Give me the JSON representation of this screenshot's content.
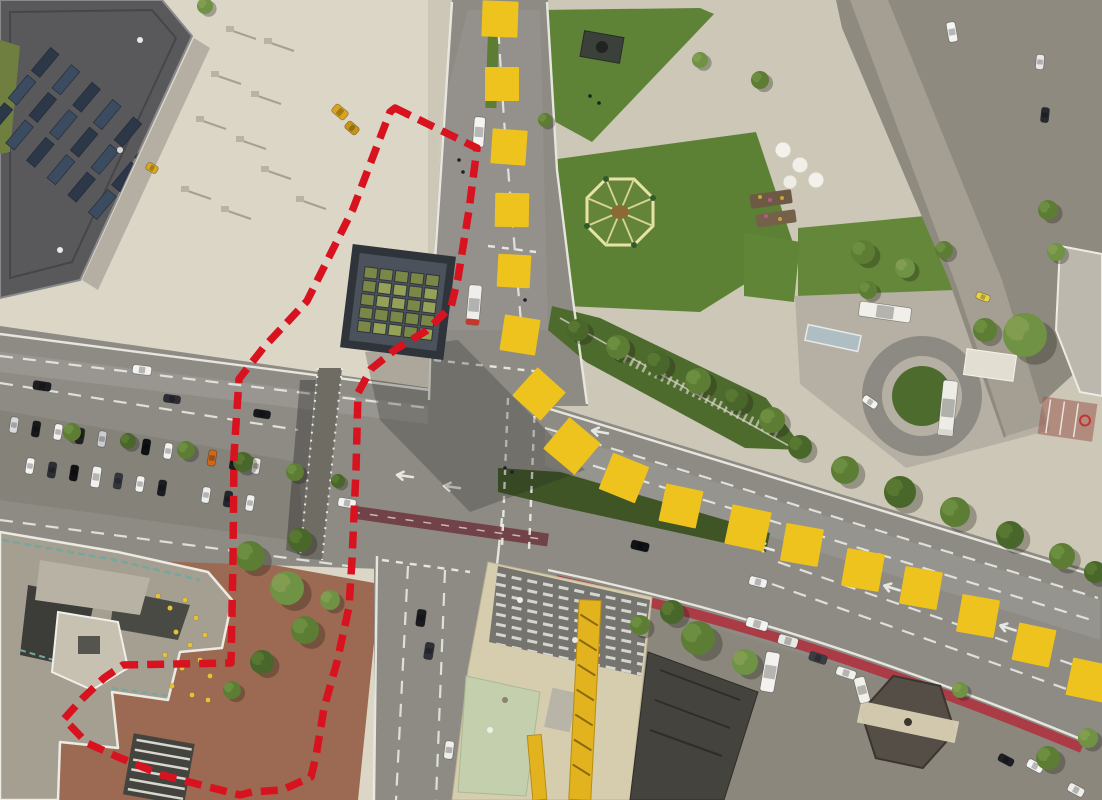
{
  "meta": {
    "kind": "aerial-orthophoto-with-planning-overlays",
    "width": 1102,
    "height": 800
  },
  "palette": {
    "marker_yellow": "#eec31e",
    "boundary_red": "#d9121f",
    "lawn_green": "#5e8236",
    "road_gray": "#8e8b85",
    "plaza_beige": "#dcd6c6",
    "south_plaza_red": "#9c6a52",
    "roof_terracotta": "#b65133",
    "bike_lane_red": "#ae3440",
    "bus_lane_maroon": "#6e3a40",
    "teal_railing": "#6fa39a",
    "tree_tones": [
      "#49662b",
      "#5d7d35",
      "#6f9245",
      "#87a051"
    ]
  },
  "overlays": {
    "boundary": {
      "color": "#d9121f",
      "style": "dashed",
      "stroke_width": 7.5,
      "dash": [
        17,
        9
      ],
      "closed": true,
      "points": [
        [
          395,
          108
        ],
        [
          477,
          148
        ],
        [
          469,
          210
        ],
        [
          458,
          278
        ],
        [
          451,
          307
        ],
        [
          426,
          331
        ],
        [
          396,
          349
        ],
        [
          371,
          369
        ],
        [
          358,
          393
        ],
        [
          356,
          470
        ],
        [
          352,
          560
        ],
        [
          349,
          607
        ],
        [
          337,
          662
        ],
        [
          324,
          708
        ],
        [
          316,
          756
        ],
        [
          311,
          777
        ],
        [
          282,
          790
        ],
        [
          252,
          792
        ],
        [
          240,
          795
        ],
        [
          205,
          786
        ],
        [
          162,
          775
        ],
        [
          118,
          757
        ],
        [
          87,
          743
        ],
        [
          64,
          719
        ],
        [
          82,
          699
        ],
        [
          104,
          678
        ],
        [
          123,
          665
        ],
        [
          175,
          664
        ],
        [
          231,
          663
        ],
        [
          233,
          560
        ],
        [
          234,
          455
        ],
        [
          239,
          379
        ],
        [
          264,
          347
        ],
        [
          307,
          301
        ],
        [
          353,
          209
        ],
        [
          390,
          112
        ]
      ]
    },
    "route_markers": {
      "color": "#eec31e",
      "shape": "square",
      "squares": [
        [
          500,
          19,
          36,
          2
        ],
        [
          502,
          84,
          34,
          0
        ],
        [
          509,
          147,
          35,
          4
        ],
        [
          512,
          210,
          34,
          1
        ],
        [
          514,
          271,
          33,
          3
        ],
        [
          520,
          335,
          36,
          9
        ],
        [
          539,
          394,
          38,
          42
        ],
        [
          572,
          446,
          41,
          40
        ],
        [
          624,
          478,
          39,
          22
        ],
        [
          681,
          506,
          38,
          12
        ],
        [
          748,
          528,
          40,
          12
        ],
        [
          802,
          545,
          38,
          10
        ],
        [
          863,
          570,
          38,
          10
        ],
        [
          921,
          588,
          38,
          10
        ],
        [
          978,
          616,
          38,
          10
        ],
        [
          1034,
          645,
          38,
          12
        ],
        [
          1088,
          680,
          38,
          12
        ]
      ]
    }
  },
  "scene": {
    "features": [
      "solar-roof-building-northwest",
      "paved-plaza",
      "subway-pavilion-glass-roof",
      "city-park-lawns",
      "octagon-fountain",
      "old-town-rooftops",
      "pedestrian-street",
      "multilane-arterial-road",
      "median-parking-strip",
      "grass-median",
      "pedestrian-bridge",
      "terraced-building-complex-southwest",
      "cafe-terrace",
      "construction-site-with-crane",
      "hexagonal-kiosk",
      "bike-lane",
      "service-yard-turnaround"
    ],
    "trees": [
      [
        72,
        432,
        9,
        1
      ],
      [
        128,
        441,
        8,
        0
      ],
      [
        186,
        450,
        9,
        1
      ],
      [
        243,
        462,
        10,
        0
      ],
      [
        295,
        472,
        9,
        1
      ],
      [
        338,
        481,
        7,
        0
      ],
      [
        578,
        330,
        11,
        0
      ],
      [
        618,
        347,
        12,
        1
      ],
      [
        658,
        363,
        12,
        0
      ],
      [
        698,
        381,
        13,
        1
      ],
      [
        736,
        399,
        12,
        0
      ],
      [
        772,
        420,
        13,
        1
      ],
      [
        800,
        447,
        12,
        0
      ],
      [
        845,
        470,
        14,
        1
      ],
      [
        900,
        492,
        16,
        0
      ],
      [
        955,
        512,
        15,
        1
      ],
      [
        1010,
        535,
        14,
        0
      ],
      [
        1062,
        556,
        13,
        1
      ],
      [
        1095,
        572,
        11,
        0
      ],
      [
        1025,
        335,
        22,
        2
      ],
      [
        985,
        330,
        12,
        1
      ],
      [
        863,
        252,
        12,
        1
      ],
      [
        905,
        268,
        10,
        2
      ],
      [
        944,
        250,
        9,
        1
      ],
      [
        760,
        80,
        9,
        1
      ],
      [
        700,
        60,
        8,
        2
      ],
      [
        545,
        120,
        7,
        1
      ],
      [
        1048,
        210,
        10,
        1
      ],
      [
        1056,
        252,
        9,
        2
      ],
      [
        868,
        290,
        9,
        1
      ],
      [
        698,
        638,
        17,
        1
      ],
      [
        745,
        662,
        13,
        2
      ],
      [
        672,
        612,
        12,
        0
      ],
      [
        1048,
        758,
        12,
        1
      ],
      [
        1088,
        738,
        10,
        2
      ],
      [
        960,
        690,
        8,
        2
      ],
      [
        250,
        556,
        15,
        1
      ],
      [
        287,
        588,
        17,
        2
      ],
      [
        305,
        630,
        14,
        1
      ],
      [
        262,
        662,
        12,
        0
      ],
      [
        330,
        600,
        10,
        2
      ],
      [
        232,
        690,
        9,
        1
      ],
      [
        300,
        540,
        12,
        0
      ],
      [
        205,
        6,
        8,
        2
      ],
      [
        640,
        625,
        10,
        1
      ]
    ],
    "vehicles": [
      [
        42,
        386,
        8,
        18,
        9,
        "#1c1e22"
      ],
      [
        142,
        370,
        7,
        19,
        9,
        "#f2f2f0"
      ],
      [
        172,
        399,
        8,
        17,
        8,
        "#2a2d33"
      ],
      [
        262,
        414,
        9,
        17,
        8,
        "#16181c"
      ],
      [
        479,
        132,
        94,
        30,
        11,
        "#f4f4f2"
      ],
      [
        474,
        305,
        95,
        40,
        13,
        "#eeeeec",
        "#c0392b"
      ],
      [
        14,
        425,
        99,
        16,
        8,
        "#d8dadd"
      ],
      [
        36,
        429,
        99,
        16,
        8,
        "#17191d"
      ],
      [
        58,
        432,
        99,
        16,
        8,
        "#f0f0ee"
      ],
      [
        80,
        436,
        99,
        16,
        8,
        "#22252a"
      ],
      [
        102,
        439,
        99,
        16,
        8,
        "#caccce"
      ],
      [
        146,
        447,
        99,
        16,
        8,
        "#0f1114"
      ],
      [
        168,
        451,
        99,
        16,
        8,
        "#f2f2f0"
      ],
      [
        212,
        458,
        99,
        16,
        8,
        "#cc671c"
      ],
      [
        234,
        462,
        99,
        16,
        8,
        "#1b1e23"
      ],
      [
        256,
        466,
        99,
        16,
        8,
        "#e8e8e6"
      ],
      [
        30,
        466,
        99,
        16,
        8,
        "#f4f4f2"
      ],
      [
        52,
        470,
        99,
        16,
        8,
        "#2c2f35"
      ],
      [
        74,
        473,
        99,
        16,
        8,
        "#101215"
      ],
      [
        96,
        477,
        99,
        21,
        9,
        "#f0f0ee"
      ],
      [
        118,
        481,
        99,
        16,
        8,
        "#33373d"
      ],
      [
        140,
        484,
        99,
        16,
        8,
        "#f2f2f0"
      ],
      [
        162,
        488,
        99,
        16,
        8,
        "#1a1d21"
      ],
      [
        206,
        495,
        99,
        16,
        8,
        "#eceeee"
      ],
      [
        228,
        499,
        99,
        16,
        8,
        "#23262c"
      ],
      [
        250,
        503,
        99,
        16,
        8,
        "#f0f0ee"
      ],
      [
        347,
        503,
        10,
        18,
        9,
        "#f2f2f2"
      ],
      [
        640,
        546,
        13,
        18,
        9,
        "#101215"
      ],
      [
        758,
        582,
        14,
        18,
        9,
        "#f0f0ee"
      ],
      [
        421,
        618,
        98,
        17,
        9,
        "#1a1c20"
      ],
      [
        429,
        651,
        99,
        17,
        9,
        "#2e3238"
      ],
      [
        449,
        750,
        97,
        18,
        9,
        "#eeeeec"
      ],
      [
        1040,
        62,
        95,
        15,
        8,
        "#e8e8e6"
      ],
      [
        1045,
        115,
        96,
        15,
        8,
        "#26292e"
      ],
      [
        952,
        32,
        80,
        20,
        9,
        "#f4f4f2"
      ],
      [
        885,
        312,
        8,
        52,
        15,
        "#f0efe9"
      ],
      [
        948,
        408,
        96,
        55,
        15,
        "#edece6",
        "#d8d8d0"
      ],
      [
        870,
        402,
        35,
        16,
        8,
        "#f4f4f2"
      ],
      [
        983,
        297,
        20,
        14,
        7,
        "#e8d24a"
      ],
      [
        757,
        624,
        16,
        22,
        10,
        "#f2f2ef"
      ],
      [
        788,
        641,
        16,
        20,
        10,
        "#e8e8e4"
      ],
      [
        818,
        658,
        18,
        18,
        9,
        "#3a3e44"
      ],
      [
        846,
        673,
        18,
        20,
        9,
        "#f0f0ec"
      ],
      [
        770,
        672,
        100,
        40,
        14,
        "#f3f2ee"
      ],
      [
        862,
        690,
        75,
        26,
        11,
        "#f1f0ea"
      ],
      [
        1035,
        766,
        28,
        17,
        9,
        "#f4f4f2"
      ],
      [
        1076,
        790,
        28,
        17,
        9,
        "#eeeeec"
      ],
      [
        1006,
        760,
        28,
        16,
        8,
        "#1c1f24"
      ],
      [
        340,
        112,
        40,
        16,
        10,
        "#d8a41c"
      ],
      [
        352,
        128,
        40,
        14,
        9,
        "#c89418"
      ],
      [
        152,
        168,
        30,
        12,
        8,
        "#d8a81e"
      ]
    ],
    "cafe_chairs": [
      [
        158,
        596
      ],
      [
        170,
        608
      ],
      [
        185,
        600
      ],
      [
        196,
        618
      ],
      [
        176,
        632
      ],
      [
        190,
        645
      ],
      [
        205,
        635
      ],
      [
        165,
        655
      ],
      [
        182,
        668
      ],
      [
        200,
        660
      ],
      [
        210,
        676
      ],
      [
        172,
        686
      ],
      [
        192,
        695
      ],
      [
        208,
        700
      ]
    ],
    "pedestrians": [
      [
        505,
        468
      ],
      [
        512,
        472
      ],
      [
        590,
        96
      ],
      [
        599,
        103
      ],
      [
        459,
        160
      ],
      [
        463,
        172
      ],
      [
        525,
        300
      ]
    ]
  }
}
